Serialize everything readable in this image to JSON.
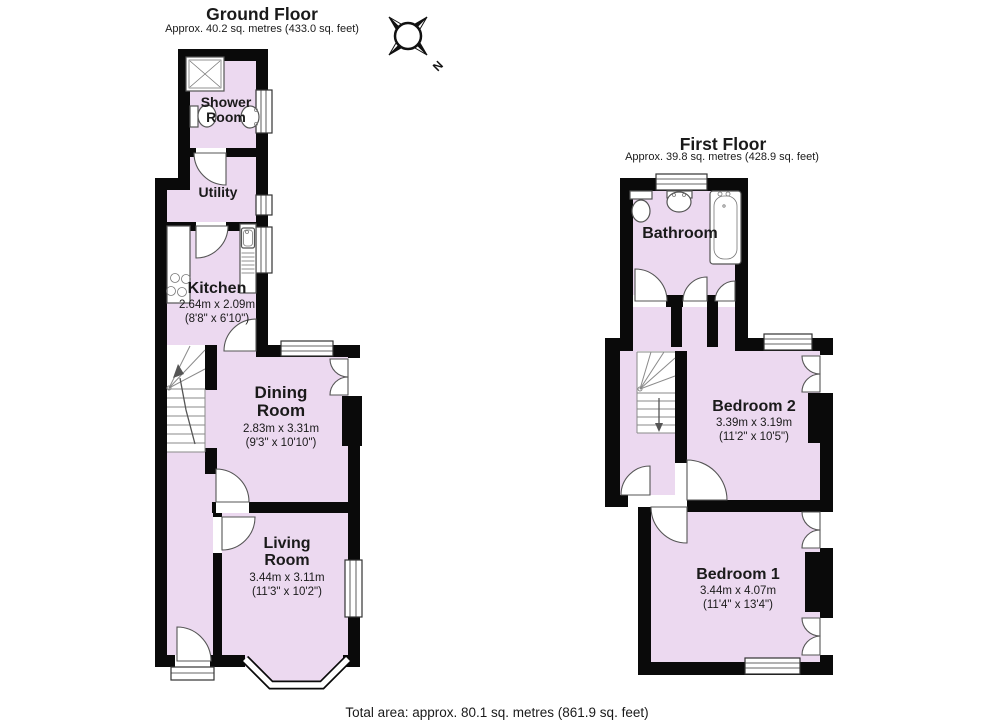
{
  "colors": {
    "floor_fill": "#ecd9f0",
    "wall": "#0a0a0a"
  },
  "compass": {
    "label": "N"
  },
  "ground_floor": {
    "title": "Ground Floor",
    "subtitle": "Approx. 40.2 sq. metres (433.0 sq. feet)",
    "rooms": {
      "shower_room": {
        "name": "Shower Room"
      },
      "utility": {
        "name": "Utility"
      },
      "kitchen": {
        "name": "Kitchen",
        "dims_metric": "2.64m x 2.09m",
        "dims_imperial": "(8'8\" x 6'10\")"
      },
      "dining_room": {
        "name": "Dining Room",
        "dims_metric": "2.83m x 3.31m",
        "dims_imperial": "(9'3\" x 10'10\")"
      },
      "living_room": {
        "name": "Living Room",
        "dims_metric": "3.44m x 3.11m",
        "dims_imperial": "(11'3\" x 10'2\")"
      }
    }
  },
  "first_floor": {
    "title": "First Floor",
    "subtitle": "Approx. 39.8 sq. metres (428.9 sq. feet)",
    "rooms": {
      "bathroom": {
        "name": "Bathroom"
      },
      "bedroom_2": {
        "name": "Bedroom 2",
        "dims_metric": "3.39m x 3.19m",
        "dims_imperial": "(11'2\" x 10'5\")"
      },
      "bedroom_1": {
        "name": "Bedroom 1",
        "dims_metric": "3.44m x 4.07m",
        "dims_imperial": "(11'4\" x 13'4\")"
      }
    }
  },
  "footer": {
    "total_area": "Total area: approx. 80.1 sq. metres (861.9 sq. feet)"
  }
}
